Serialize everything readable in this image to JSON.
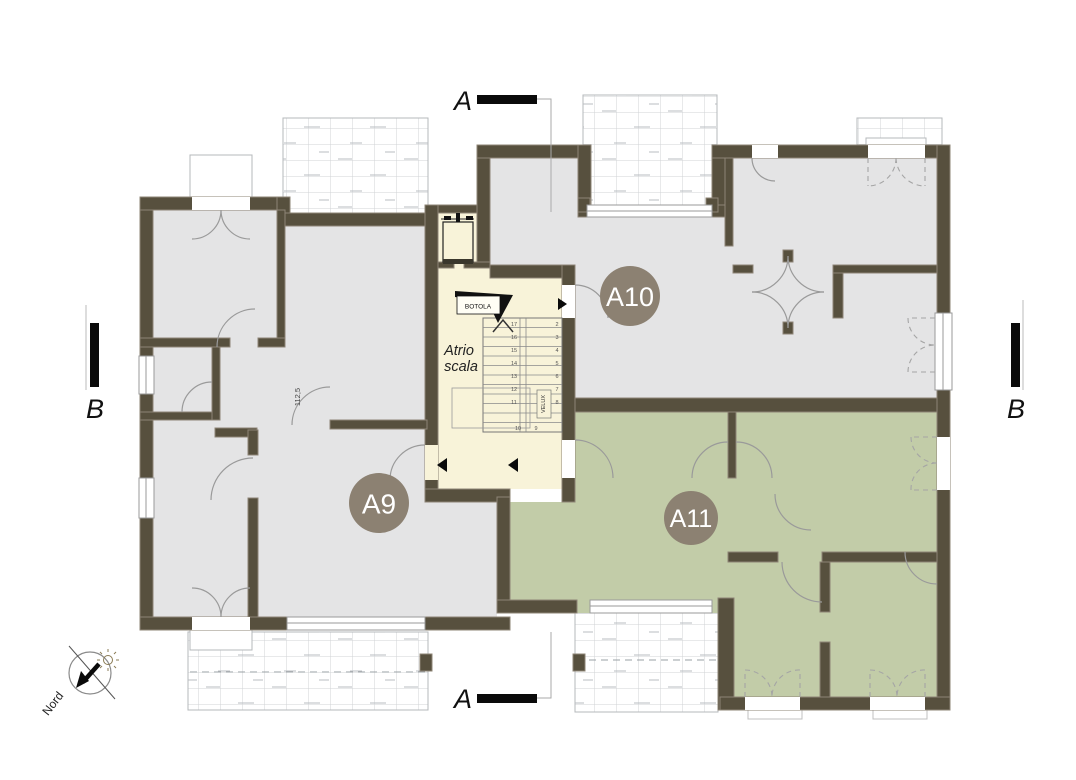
{
  "plan": {
    "apartments": {
      "a9": "A9",
      "a10": "A10",
      "a11": "A11"
    },
    "stairwell": {
      "atrio_line1": "Atrio",
      "atrio_line2": "scala",
      "botola": "BOTOLA",
      "velux": "VELUX",
      "numbers_left": [
        "17",
        "16",
        "15",
        "14",
        "13",
        "12",
        "11"
      ],
      "numbers_right": [
        "2",
        "3",
        "4",
        "5",
        "6",
        "7",
        "8"
      ],
      "numbers_mid": [
        "10",
        "9"
      ]
    },
    "sections": {
      "a_top": "A",
      "a_bottom": "A",
      "b_left": "B",
      "b_right": "B"
    },
    "compass": {
      "label": "Nord"
    },
    "dimensions": {
      "d1": "112,5"
    },
    "colors": {
      "wall": "#57503e",
      "wall_edge": "#8e8476",
      "room_gray": "#e4e4e5",
      "room_green": "#c2cca8",
      "stair_cream": "#f8f3d9",
      "label_circle": "#8c8172",
      "tile_line": "#d0d3d6",
      "section_bar": "#0a0a0a"
    }
  }
}
